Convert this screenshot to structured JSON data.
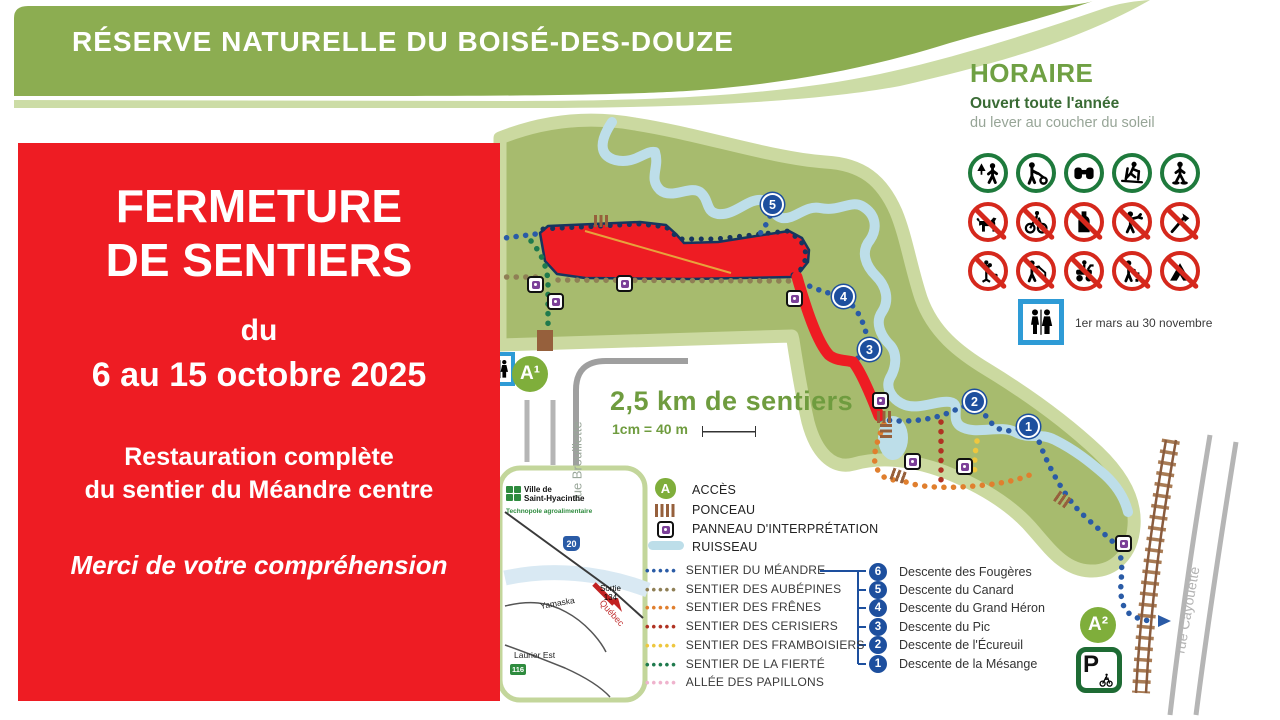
{
  "colors": {
    "banner_green": "#8CAD51",
    "banner_stripe": "#CCDCA6",
    "land": "#A7BB6E",
    "land_border": "#CBD9A0",
    "stream": "#BDDEE9",
    "closure_red": "#EE1C23",
    "marker_navy": "#1D4F9E",
    "access_green": "#7FAE3B",
    "parking_green": "#1E6B34",
    "restroom_blue": "#2E9BD6",
    "allowed_green": "#1E7A3C",
    "prohibited_red": "#D5281C",
    "panneau_purple": "#7B3F98",
    "ponceau_brown": "#96603C",
    "horaire_title_green": "#6FA043",
    "horaire_sub_green": "#3A6B35",
    "horaire_gray": "#97A597",
    "km_green": "#6F9C3F"
  },
  "banner": {
    "title": "RÉSERVE NATURELLE DU BOISÉ-DES-DOUZE"
  },
  "notice": {
    "l1": "FERMETURE",
    "l2": "DE SENTIERS",
    "l3": "du",
    "l4": "6 au 15 octobre 2025",
    "l5": "Restauration complète",
    "l6": "du sentier du Méandre centre",
    "l7": "Merci de votre compréhension"
  },
  "horaire": {
    "title": "HORAIRE",
    "subtitle": "Ouvert toute l'année",
    "hours": "du lever au coucher du soleil",
    "restroom_note": "1er mars au 30 novembre",
    "allowed_icons": [
      "hiking",
      "walking-with-stroller",
      "birdwatching",
      "cross-country-ski",
      "snowshoe"
    ],
    "prohibited_icons": [
      "no-dogs",
      "no-cycling",
      "no-alcohol",
      "no-hunting",
      "no-wood-cutting",
      "no-plant-picking",
      "no-fishing",
      "no-motorized-vehicles",
      "no-littering",
      "no-camping"
    ]
  },
  "map_labels": {
    "length": "2,5 km de sentiers",
    "scale": "1cm = 40 m",
    "rue_brouillette": "rue Brouillette",
    "rue_cayouette": "rue Cayouette",
    "access1": "A¹",
    "access2": "A²",
    "parking": "P"
  },
  "markers": [
    "1",
    "2",
    "3",
    "4",
    "5"
  ],
  "legend_items": [
    {
      "label": "ACCÈS"
    },
    {
      "label": "PONCEAU"
    },
    {
      "label": "PANNEAU D'INTERPRÉTATION"
    },
    {
      "label": "RUISSEAU"
    }
  ],
  "trails": [
    {
      "label": "SENTIER DU MÉANDRE",
      "color": "#2A5BA6"
    },
    {
      "label": "SENTIER DES AUBÉPINES",
      "color": "#8F7F55"
    },
    {
      "label": "SENTIER DES FRÊNES",
      "color": "#E07F2E"
    },
    {
      "label": "SENTIER DES CERISIERS",
      "color": "#B03323"
    },
    {
      "label": "SENTIER DES FRAMBOISIERS",
      "color": "#EEC73E"
    },
    {
      "label": "SENTIER DE LA FIERTÉ",
      "color": "#1F7A4D"
    },
    {
      "label": "ALLÉE DES PAPILLONS",
      "color": "#EFB3CD"
    }
  ],
  "descentes": [
    {
      "num": "6",
      "label": "Descente des Fougères"
    },
    {
      "num": "5",
      "label": "Descente du Canard"
    },
    {
      "num": "4",
      "label": "Descente du Grand Héron"
    },
    {
      "num": "3",
      "label": "Descente du Pic"
    },
    {
      "num": "2",
      "label": "Descente de l'Écureuil"
    },
    {
      "num": "1",
      "label": "Descente de la Mésange"
    }
  ],
  "inset": {
    "city1": "Ville de",
    "city2": "Saint-Hyacinthe",
    "tagline": "Technopole agroalimentaire",
    "hwy": "20",
    "exit1": "Sortie",
    "exit2": "134",
    "river": "Yamaska",
    "direction": "Québec",
    "street": "Laurier Est",
    "hwy2": "116"
  }
}
